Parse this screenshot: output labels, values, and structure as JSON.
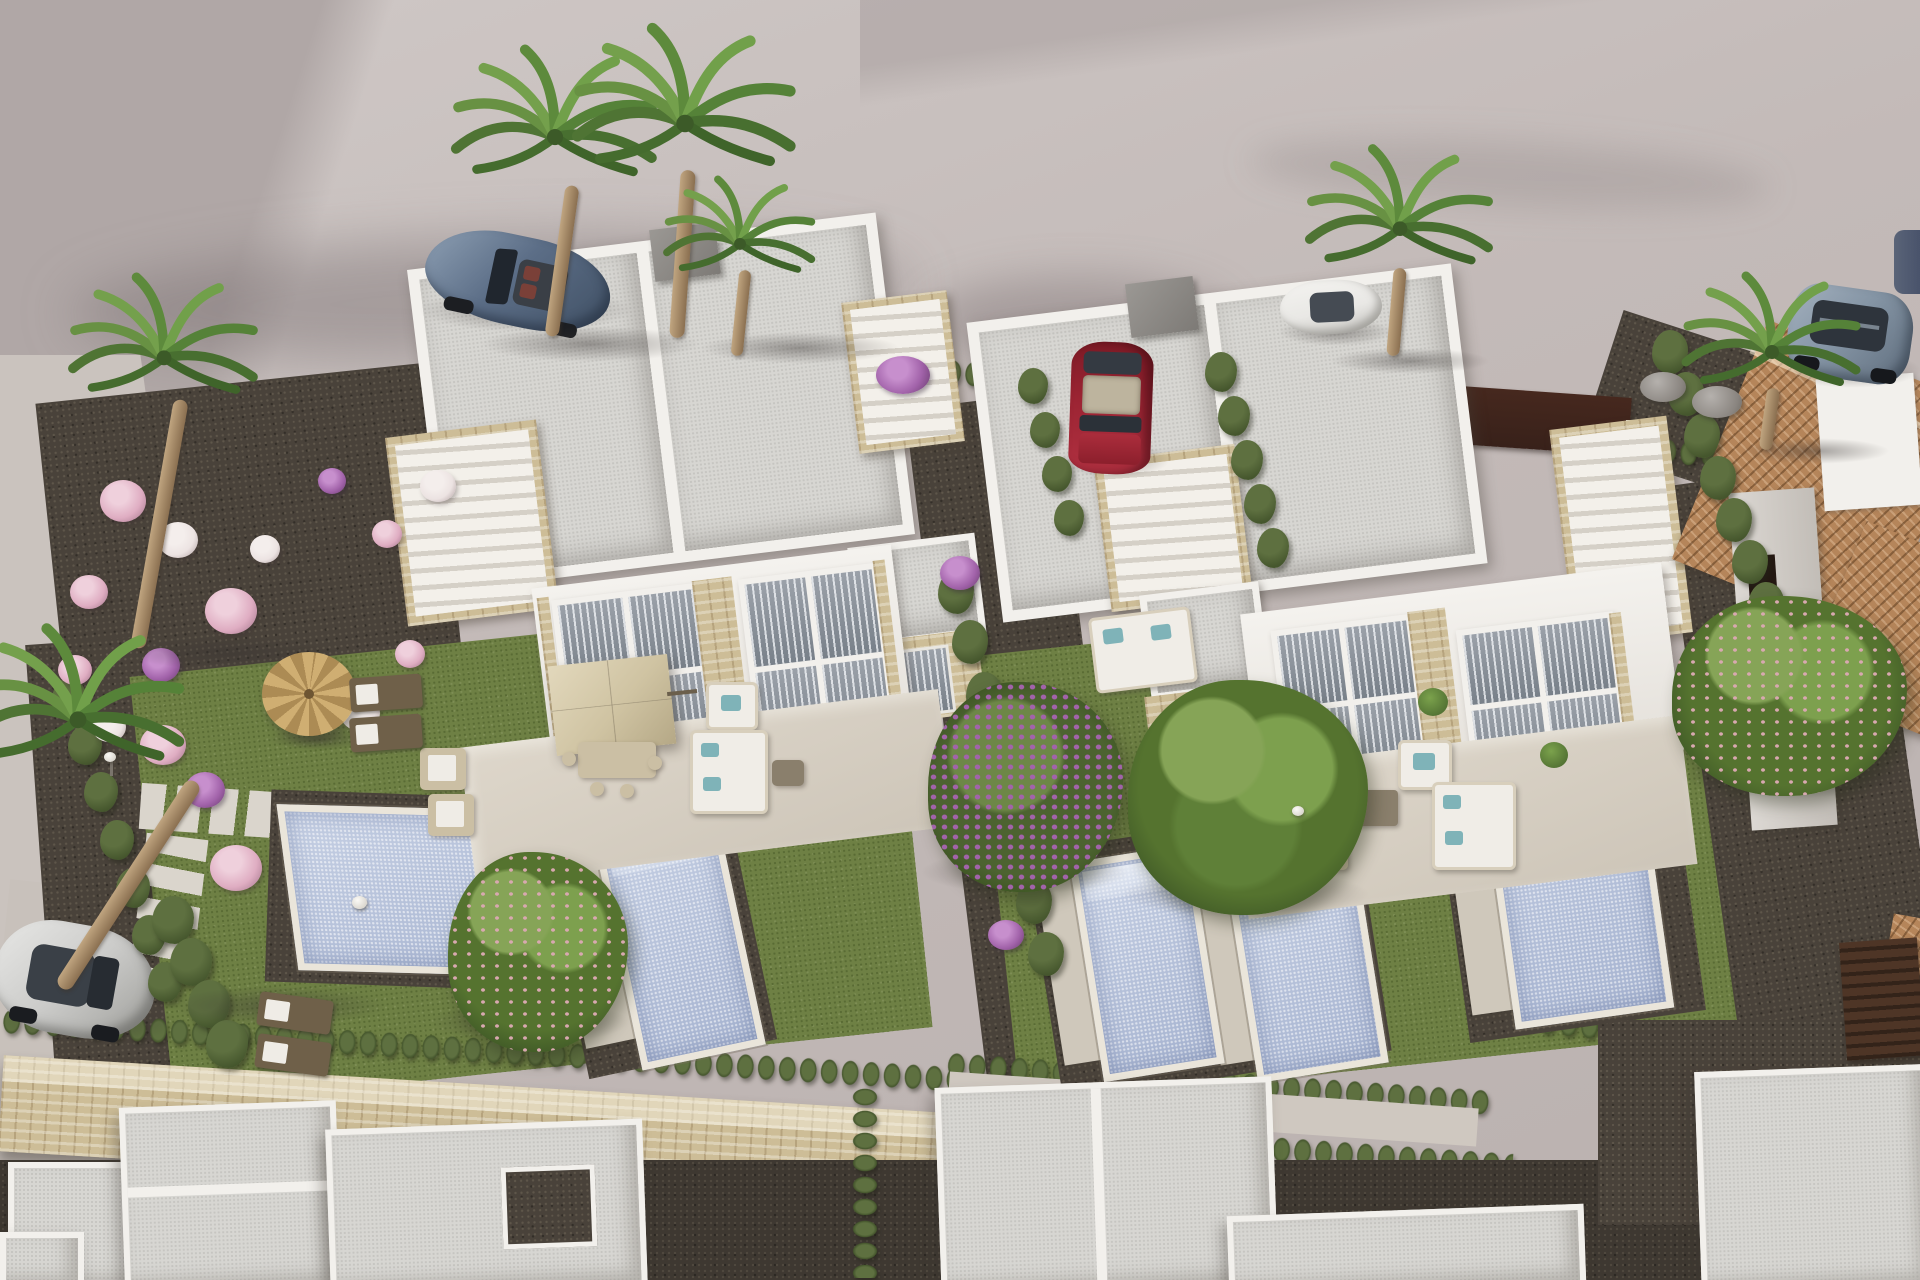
{
  "scene": {
    "type": "photorealistic 3D architectural render",
    "view": "aerial three-quarter view of a new-build residential development",
    "setting": "two modern white duplex villas with private pools, landscaped gardens, cypress hedges, palm trees and parked cars; existing terracotta-roof house on the right; unfinished white building shells in the foreground; curved asphalt road at the top",
    "time_of_day": "bright daylight, soft shadows falling to the lower-left"
  },
  "palette": {
    "ground": "#c3bab8",
    "ground_light": "#cfc8c6",
    "ground_dark": "#b0a7a6",
    "wall": "#f2f0ec",
    "wall_shade": "#dedad4",
    "roof": "#d7d6d2",
    "roof_dot": "#c6c5c1",
    "stone": "#cdbd97",
    "stone_dark": "#b5a47c",
    "pool": "#b4c0d9",
    "coping": "#eae5da",
    "grass": "#6e8044",
    "grass_dark": "#596b34",
    "hedge": "#5e7040",
    "hedge_dark": "#45562d",
    "gravel": "#49423a",
    "gravel_dot": "#5e564a",
    "pavement": "#d6cfc4",
    "deck": "#cfc8bb",
    "terracotta": "#b5855a",
    "gate": "#38211a",
    "flower_pink": "#dfadc2",
    "flower_white": "#ece3e2",
    "flower_purple": "#a263aa",
    "blossom": "#d8a8b0",
    "teal": "#7fb3b8",
    "furn": "#cbbfa4",
    "white_furn": "#f0ede7",
    "lounger": "#6f6049",
    "straw": "#c8a96e",
    "parasol": "#d6caab",
    "car_blue": "#5c6e87",
    "car_red": "#9c2433",
    "car_white": "#e9e8e5",
    "car_suv": "#8595a5",
    "car_silver": "#cbcbc9",
    "car_dark": "#49536b"
  },
  "objects": {
    "buildings": [
      {
        "name": "left-duplex-villa",
        "style": "modern white flat-roof duplex",
        "features": [
          "speckled gray flat roofs",
          "rooftop stair access with travertine cladding at both ends",
          "floor-to-ceiling windows with gray curtains",
          "travertine stone piers",
          "front terrace with beige parasol and lounge furniture"
        ]
      },
      {
        "name": "right-duplex-villa",
        "style": "modern white flat-roof duplex",
        "features": [
          "same design as left villa",
          "red car parked in side driveway",
          "terrace with white corner sofa and potted plants"
        ]
      },
      {
        "name": "right-end-villa-unit",
        "note": "third matching unit partially visible at far right with own stair tower, terrace and pool"
      },
      {
        "name": "neighbor-house",
        "style": "existing house with terracotta tile roofs, gray walls and dark window openings"
      },
      {
        "name": "foreground-building-shells",
        "count": 6,
        "note": "white flat-roof structures under construction along the bottom edge"
      }
    ],
    "pools": [
      {
        "name": "pool-left-large",
        "shape": "wide rectangle with corner steps"
      },
      {
        "name": "pool-left-small",
        "shape": "narrow rectangle with top steps"
      },
      {
        "name": "pool-right-1",
        "shape": "narrow rectangle with top steps"
      },
      {
        "name": "pool-right-2",
        "shape": "narrow rectangle with top steps"
      },
      {
        "name": "pool-right-3",
        "shape": "rectangle with top steps, far right unit"
      }
    ],
    "vehicles": [
      {
        "name": "blue-convertible",
        "location": "top-left road",
        "color_ref": "car_blue",
        "detail": "open top, tan-red interior visible"
      },
      {
        "name": "red-hatchback",
        "location": "center driveway between villas",
        "color_ref": "car_red"
      },
      {
        "name": "white-sedan",
        "location": "top-center road behind hedge",
        "color_ref": "car_white"
      },
      {
        "name": "gray-suv",
        "location": "top-right road",
        "color_ref": "car_suv"
      },
      {
        "name": "silver-compact",
        "location": "bottom-left lane",
        "color_ref": "car_silver"
      },
      {
        "name": "dark-suv-partial",
        "location": "clipped at right edge",
        "color_ref": "car_dark"
      }
    ],
    "vegetation": [
      {
        "name": "palm-trees",
        "count": 7,
        "locations": [
          "top-center cluster",
          "top-right",
          "far-right",
          "left edge",
          "bottom-left"
        ]
      },
      {
        "name": "cypress-hedge-rows",
        "note": "along plot boundaries and perimeter wall"
      },
      {
        "name": "bougainvillea-tree",
        "color_ref": "flower_purple",
        "location": "center path"
      },
      {
        "name": "pink-blossom-trees",
        "count": 3
      },
      {
        "name": "flower-shrubs",
        "colors": [
          "flower_pink",
          "flower_white",
          "flower_purple"
        ],
        "location": "left gravel garden"
      },
      {
        "name": "lawns",
        "color_ref": "grass"
      }
    ],
    "site_features": [
      {
        "name": "travertine-perimeter-wall",
        "location": "across lower third"
      },
      {
        "name": "dark-brown-entry-gates",
        "count": 4,
        "location": "street boundary"
      },
      {
        "name": "stepping-stone-path",
        "location": "left garden, T-shape"
      },
      {
        "name": "straw-parasol",
        "location": "left garden with two loungers"
      },
      {
        "name": "beige-patio-parasol",
        "location": "left villa terrace"
      },
      {
        "name": "sun-loungers",
        "count": 4
      },
      {
        "name": "garden-light-bollards",
        "count": 3
      },
      {
        "name": "gray-chimney-boxes",
        "count": 2
      }
    ]
  }
}
